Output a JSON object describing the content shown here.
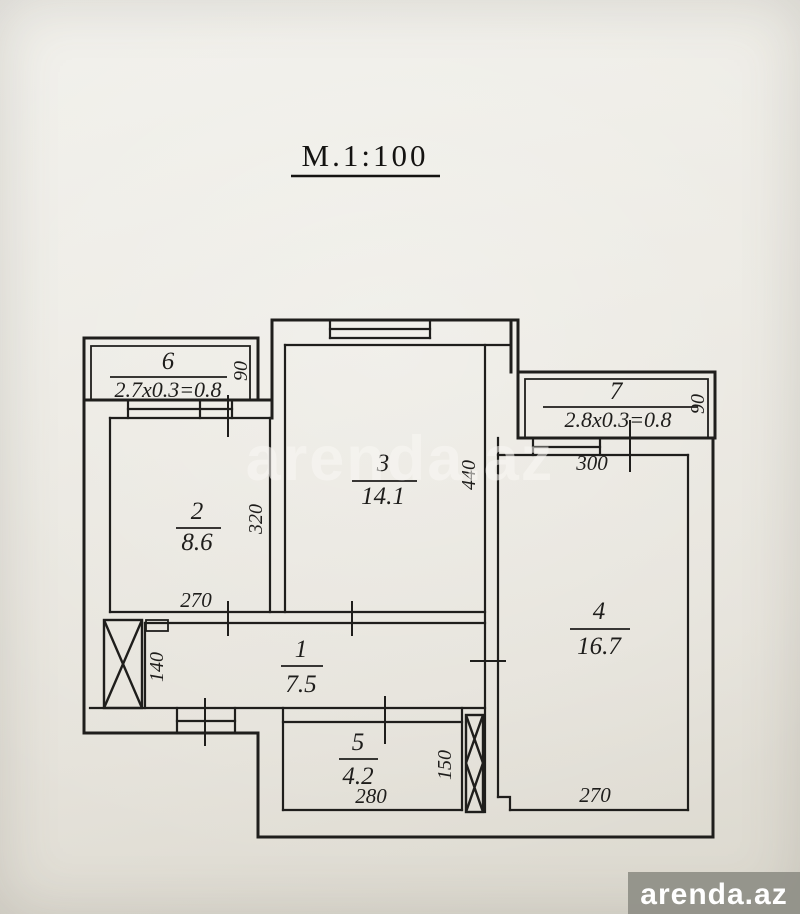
{
  "title": "М.1:100",
  "watermark": "arenda.az",
  "logo": {
    "text": "arenda.az"
  },
  "colors": {
    "line": "#1f1e1c",
    "paper": "#eae7e0",
    "logo_bg": "#8f8f87",
    "watermark": "#f9f8f4"
  },
  "rooms": {
    "r1": {
      "number": "1",
      "area": "7.5"
    },
    "r2": {
      "number": "2",
      "area": "8.6"
    },
    "r3": {
      "number": "3",
      "area": "14.1"
    },
    "r4": {
      "number": "4",
      "area": "16.7"
    },
    "r5": {
      "number": "5",
      "area": "4.2"
    },
    "r6": {
      "number": "6",
      "area": "2.7x0.3=0.8"
    },
    "r7": {
      "number": "7",
      "area": "2.8x0.3=0.8"
    }
  },
  "dimensions": {
    "room2_width": "270",
    "room2_height": "320",
    "room3_height": "440",
    "room4_top_width": "300",
    "room4_bottom_width": "270",
    "balcony6_depth": "90",
    "balcony7_depth": "90",
    "corridor_height": "140",
    "room5_width": "280",
    "room5_height": "150"
  }
}
